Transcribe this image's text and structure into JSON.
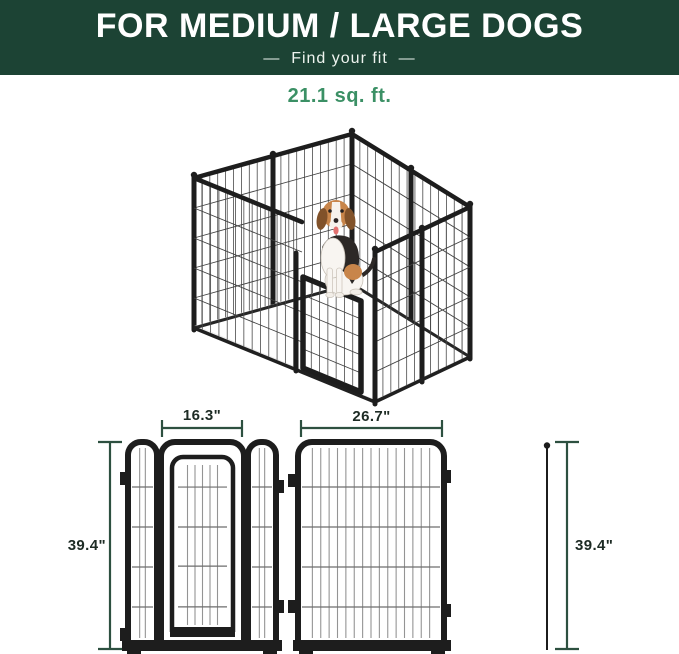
{
  "header": {
    "title": "FOR MEDIUM / LARGE DOGS",
    "subtitle": "—  Find your fit  —"
  },
  "area_label": "21.1 sq. ft.",
  "diagrams": {
    "door_panel": {
      "width_label": "16.3\"",
      "height_label": "39.4\""
    },
    "large_panel": {
      "width_label": "26.7\"",
      "height_label": "39.4\""
    }
  },
  "illustration": {
    "subject": "metal dog playpen with beagle inside",
    "dog": "beagle-illustration"
  },
  "colors": {
    "header_bg": "#1c4334",
    "accent_green": "#3b9065",
    "dimension_line": "#2d5040",
    "label_dark": "#1d2b24",
    "frame": "#1d1d1d"
  }
}
